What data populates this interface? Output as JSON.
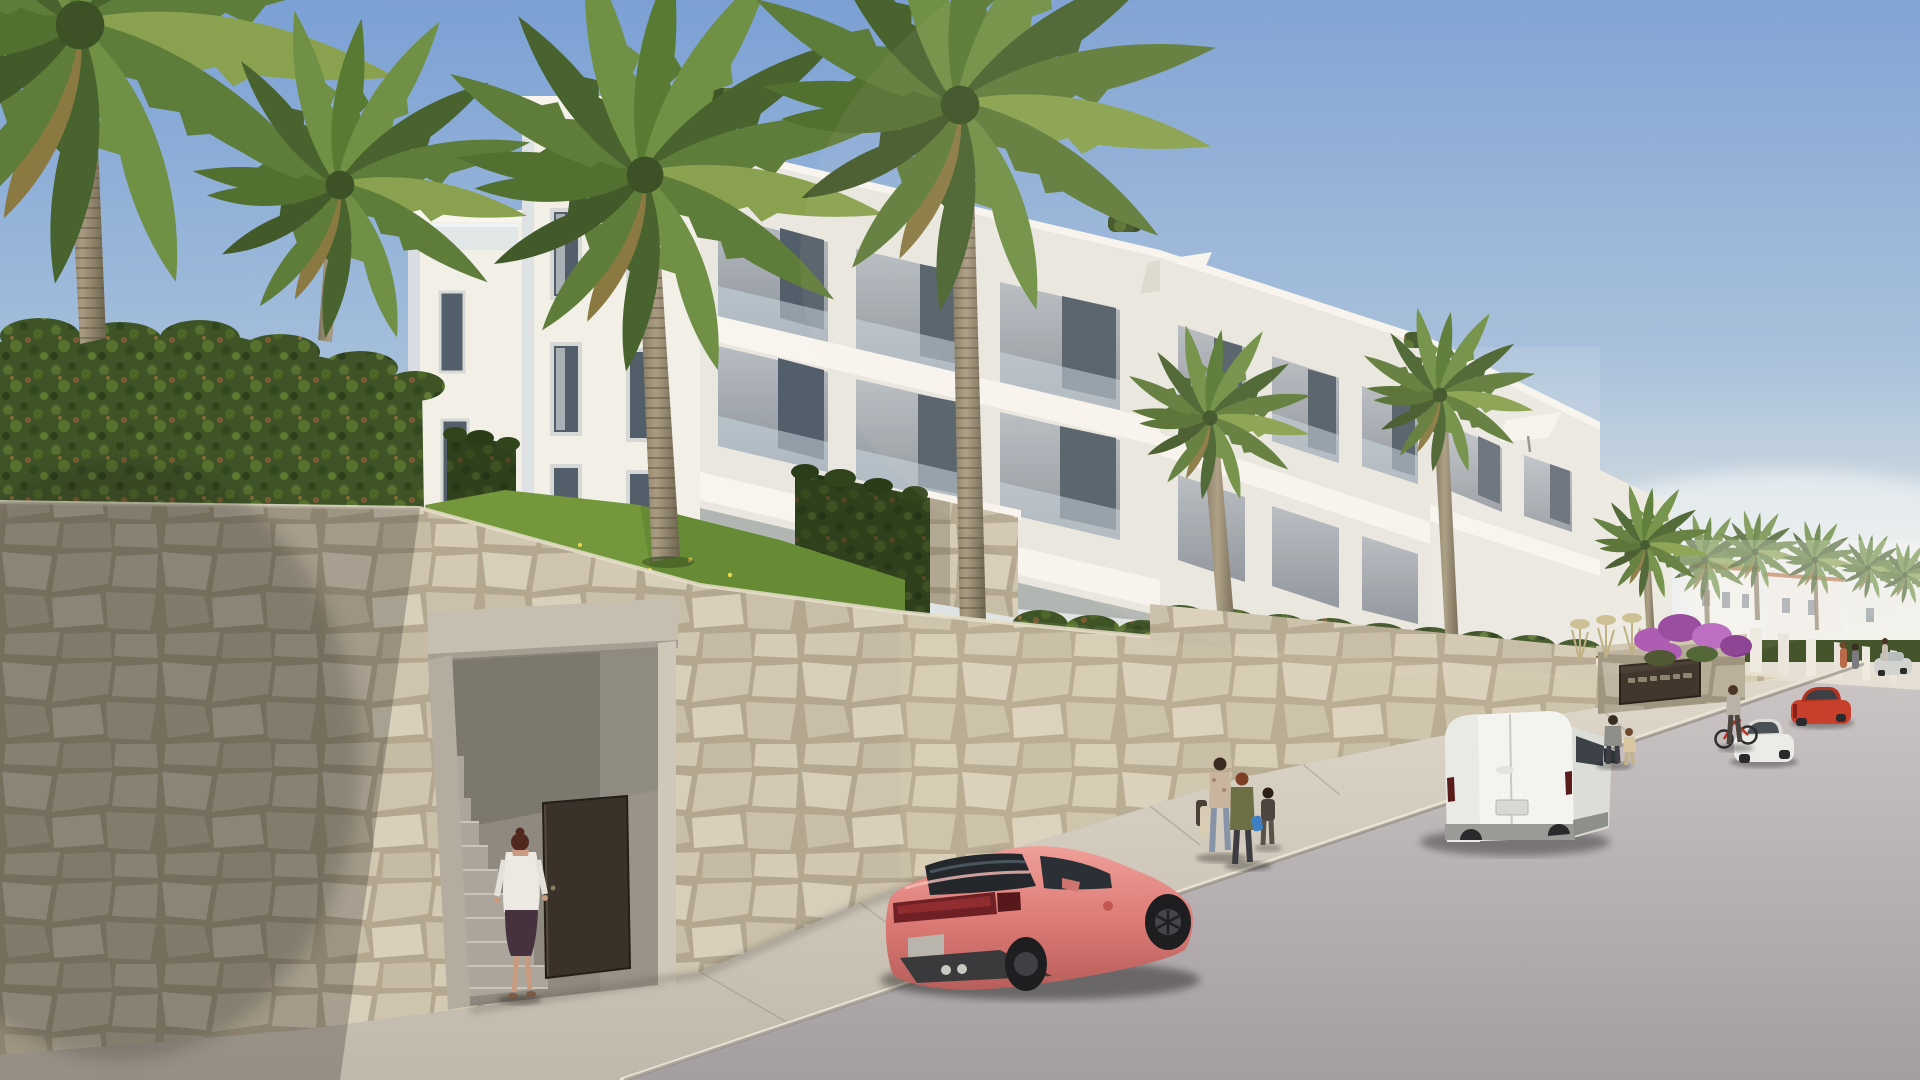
{
  "meta": {
    "title": "Architectural render: white Mediterranean apartment complex above a stone retaining wall, palm trees, coral sports car and white van parked on an ascending street",
    "type": "architectural-visualization",
    "sign_text": "",
    "sign_text_legible": false
  },
  "palette": {
    "sky_top": "#7ba0d4",
    "sky_horizon": "#e9e9e3",
    "building_white": "#f2efe7",
    "stone_wall": "#cfc5b0",
    "hedge_green": "#3e5427",
    "palm_green": "#5e7c3a",
    "lawn_green": "#74973c",
    "road_gray": "#b0a9ac",
    "sidewalk": "#d5cdbf",
    "car_coral": "#e0807a",
    "van_white": "#f2f2ef",
    "door_brown": "#3a3129",
    "bougainvillea": "#a855b0"
  },
  "scene": {
    "sky": {
      "label": "Clear blue sky"
    },
    "buildings": {
      "label": "White modern apartment blocks with recessed balconies, glass balustrades, stone-clad accents and roof parasols",
      "blocks": 5
    },
    "vegetation": {
      "label": "Palm trees, dark hedge atop the wall, sloped lawn with yellow wildflowers, purple bougainvillea",
      "palms_foreground": 6,
      "palms_distant": 7
    },
    "wall": {
      "label": "Beige natural-stone retaining wall along the street",
      "entrance": {
        "label": "Recessed pedestrian entrance with concrete stair and open dark-brown door"
      },
      "sign": {
        "label": "Dark entrance plaque with light lettering (illegible)",
        "text": ""
      }
    },
    "street": {
      "label": "Asphalt street climbing to the right with concrete sidewalk and curb"
    },
    "vehicles": [
      {
        "label": "Coral-pink sports coupe parked at the curb",
        "color": "#e0807a"
      },
      {
        "label": "White panel van parked further up the street",
        "color": "#f2f2ef"
      },
      {
        "label": "Red sedan parked in the distance",
        "color": "#c8402c"
      },
      {
        "label": "White sedan parked in the distance",
        "color": "#ebebe8"
      },
      {
        "label": "Silver car near the top of the street",
        "color": "#d2d2cf"
      }
    ],
    "people": [
      {
        "label": "Woman in white shirt entering the gated stair entrance"
      },
      {
        "label": "Two women and a child walking along the sidewalk"
      },
      {
        "label": "Man and child walking beyond the white van"
      },
      {
        "label": "Person standing with a bicycle"
      },
      {
        "label": "Distant pedestrians up the hill"
      }
    ]
  }
}
